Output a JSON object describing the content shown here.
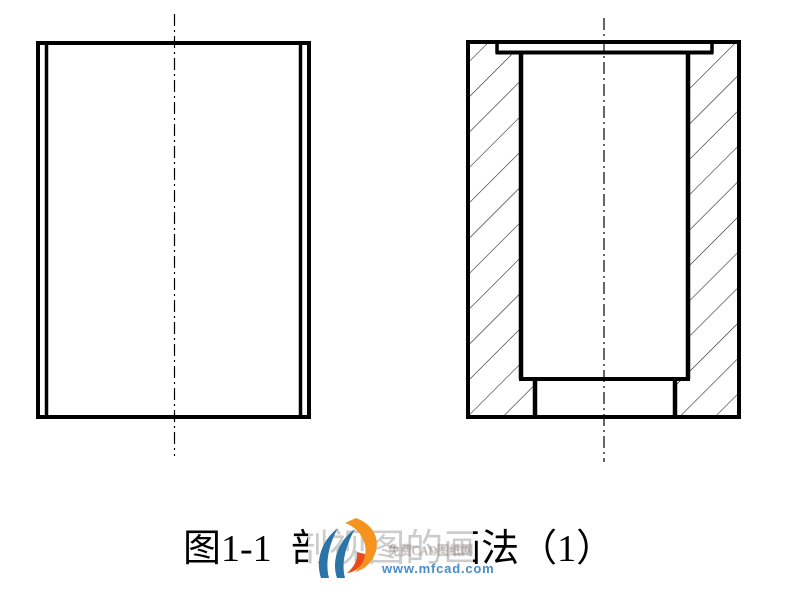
{
  "page": {
    "background_color": "#ffffff"
  },
  "drawing": {
    "line_color": "#000000",
    "hatch_color": "#141414",
    "centerline_color": "#000000"
  },
  "caption": {
    "text": "图1-1 剖视图的画法（1）"
  },
  "watermark": {
    "brand_line": "免费CAD图纸网",
    "url_line": "www.mfcad.com",
    "url_color": "#4b8cc8",
    "brand_color": "#8d817a",
    "logo_blue": "#2b74a8",
    "logo_orange": "#f6921e",
    "logo_red": "#e8491d"
  }
}
